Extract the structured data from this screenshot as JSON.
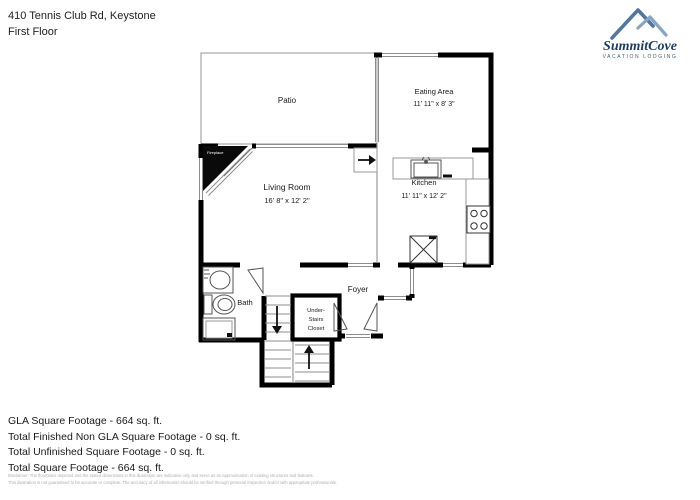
{
  "header": {
    "address": "410 Tennis Club Rd, Keystone",
    "floor": "First Floor"
  },
  "logo": {
    "name": "SummitCove",
    "tagline": "VACATION LODGING",
    "mountain_color_front": "#53779e",
    "mountain_color_back": "#8aa5c0",
    "text_color": "#1d3c5e"
  },
  "rooms": {
    "patio": {
      "label": "Patio"
    },
    "eating": {
      "label": "Eating Area",
      "dims": "11' 11\" x 8' 3\""
    },
    "living": {
      "label": "Living Room",
      "dims": "16' 8\" x 12' 2\""
    },
    "kitchen": {
      "label": "Kitchen",
      "dims": "11' 11\" x 12' 2\""
    },
    "bath": {
      "label": "Bath"
    },
    "foyer": {
      "label": "Foyer"
    },
    "closet": {
      "line1": "Under-",
      "line2": "Stairs",
      "line3": "Closet"
    },
    "fireplace": {
      "label": "Fireplace"
    }
  },
  "footer": {
    "lines": [
      "GLA Square Footage - 664 sq. ft.",
      "Total Finished Non GLA Square Footage - 0 sq. ft.",
      "Total Unfinished Square Footage - 0 sq. ft.",
      "Total Square Footage - 664 sq. ft."
    ]
  },
  "disclaimer": {
    "line1": "Disclaimer: The floorplans depicted and the stated dimensions in this illustration are indicative only and serve as an approximation of existing structures and features.",
    "line2": "This illustration is not guaranteed to be accurate or complete. The accuracy of all information should be verified through personal inspection and/or with appropriate professionals."
  }
}
